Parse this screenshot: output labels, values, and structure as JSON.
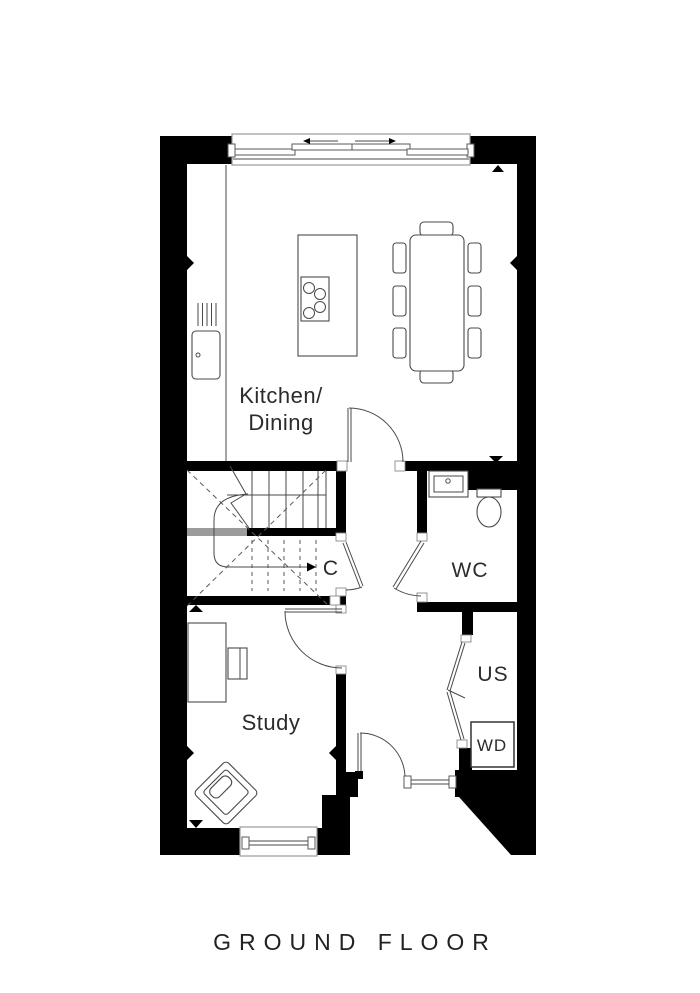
{
  "title": "GROUND FLOOR",
  "labels": {
    "kitchen_line1": "Kitchen/",
    "kitchen_line2": "Dining",
    "cupboard": "C",
    "wc": "WC",
    "study": "Study",
    "understairs": "US",
    "washer_dryer": "WD"
  },
  "icons": {
    "slide_left_arrow": "left-arrow",
    "slide_right_arrow": "right-arrow",
    "stair_up_arrow": "right-arrow",
    "dimension_markers": "triangle-marker"
  },
  "colors": {
    "wall": "#000000",
    "furniture_line": "#4a4a4a",
    "landing_highlight": "#9b9b9b",
    "text": "#2b2b2b",
    "background": "#ffffff"
  }
}
